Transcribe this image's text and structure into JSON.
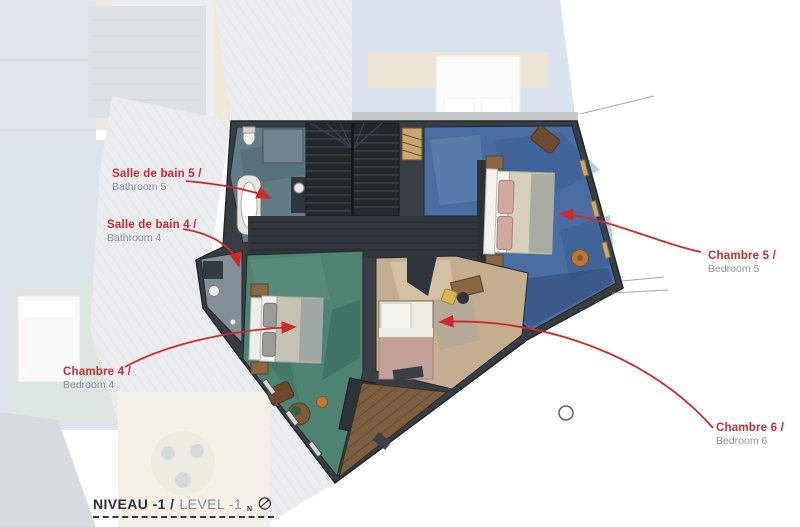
{
  "title": {
    "fr": "NIVEAU -1 /",
    "en": "LEVEL -1",
    "compass_letter": "N"
  },
  "annotations": [
    {
      "id": "bathroom-5",
      "fr": "Salle de bain 5 /",
      "en": "Bathroom 5"
    },
    {
      "id": "bathroom-4",
      "fr": "Salle de bain 4 /",
      "en": "Bathroom 4"
    },
    {
      "id": "bedroom-4",
      "fr": "Chambre 4 /",
      "en": "Bedroom 4"
    },
    {
      "id": "bedroom-5",
      "fr": "Chambre 5 /",
      "en": "Bedroom 5"
    },
    {
      "id": "bedroom-6",
      "fr": "Chambre 6 /",
      "en": "Bedroom 6"
    }
  ],
  "icons": {
    "compass": "north-arrow-circle-icon"
  },
  "colors": {
    "annotation_red": "#cd2a2e",
    "label_gray": "#8b9099",
    "title_dark": "#2b3138",
    "wall_dark": "#383d44",
    "stair_dark": "#23282d",
    "bedroom5_floor": "#4a6da1",
    "bedroom4_floor": "#4e8273",
    "bedroom6_floor": "#c5ad8f",
    "bathroom5_floor": "#607b83",
    "deck_wood": "#7b5d40",
    "window_wood": "#c8a873"
  }
}
